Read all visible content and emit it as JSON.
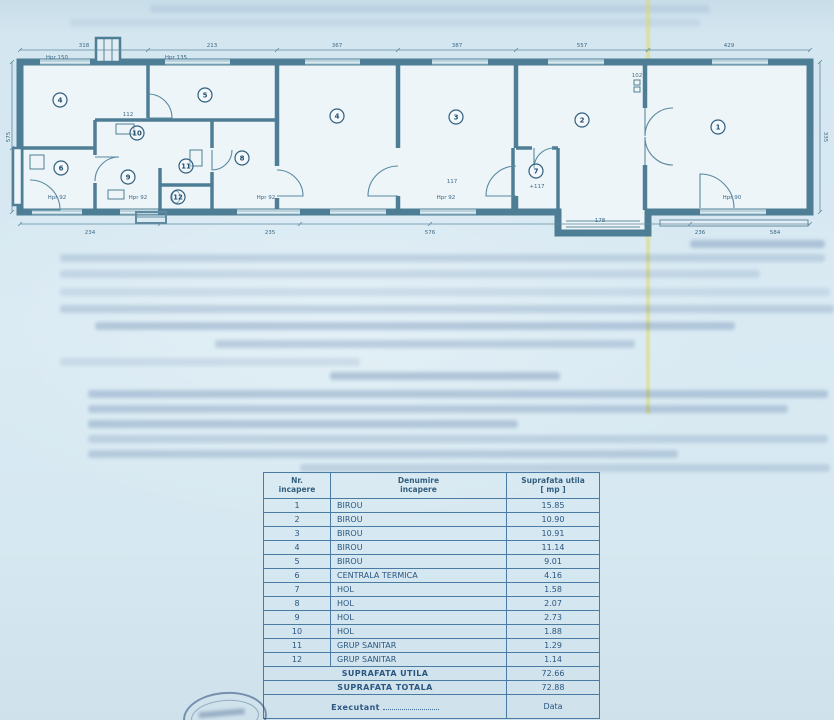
{
  "table": {
    "headers": [
      "Nr.\nincapere",
      "Denumire\nincapere",
      "Suprafata utila\n[ mp ]"
    ],
    "rows": [
      {
        "nr": "1",
        "name": "BIROU",
        "area": "15.85"
      },
      {
        "nr": "2",
        "name": "BIROU",
        "area": "10.90"
      },
      {
        "nr": "3",
        "name": "BIROU",
        "area": "10.91"
      },
      {
        "nr": "4",
        "name": "BIROU",
        "area": "11.14"
      },
      {
        "nr": "5",
        "name": "BIROU",
        "area": "9.01"
      },
      {
        "nr": "6",
        "name": "CENTRALA TERMICA",
        "area": "4.16"
      },
      {
        "nr": "7",
        "name": "HOL",
        "area": "1.58"
      },
      {
        "nr": "8",
        "name": "HOL",
        "area": "2.07"
      },
      {
        "nr": "9",
        "name": "HOL",
        "area": "2.73"
      },
      {
        "nr": "10",
        "name": "HOL",
        "area": "1.88"
      },
      {
        "nr": "11",
        "name": "GRUP SANITAR",
        "area": "1.29"
      },
      {
        "nr": "12",
        "name": "GRUP SANITAR",
        "area": "1.14"
      }
    ],
    "totals": [
      {
        "label": "SUPRAFATA UTILA",
        "value": "72.66"
      },
      {
        "label": "SUPRAFATA TOTALA",
        "value": "72.88"
      }
    ],
    "footer": {
      "left": "Executant",
      "right": "Data"
    }
  },
  "plan": {
    "rooms": [
      {
        "n": "4"
      },
      {
        "n": "5"
      },
      {
        "n": "10"
      },
      {
        "n": "9"
      },
      {
        "n": "6"
      },
      {
        "n": "11"
      },
      {
        "n": "12"
      },
      {
        "n": "8"
      },
      {
        "n": "4"
      },
      {
        "n": "3"
      },
      {
        "n": "2"
      },
      {
        "n": "1"
      },
      {
        "n": "7"
      }
    ],
    "dims_top": [
      "318",
      "213",
      "367",
      "387",
      "557",
      "429"
    ],
    "dims_bottom": [
      "234",
      "235",
      "576",
      "236",
      "584"
    ],
    "dims_left": "575",
    "dims_right": "335",
    "small_labels": [
      "Hpr 150",
      "Hpr 135",
      "Hpr 92",
      "Hpr 92",
      "Hpr 92",
      "Hpr 90",
      "Hpr 92",
      "112",
      "117",
      "178",
      "+117",
      "102"
    ]
  },
  "colors": {
    "paper": "#d6e7f0",
    "ink": "#2b5680",
    "plan_line": "#4b7f98",
    "fold_streak": "#ded66a"
  }
}
